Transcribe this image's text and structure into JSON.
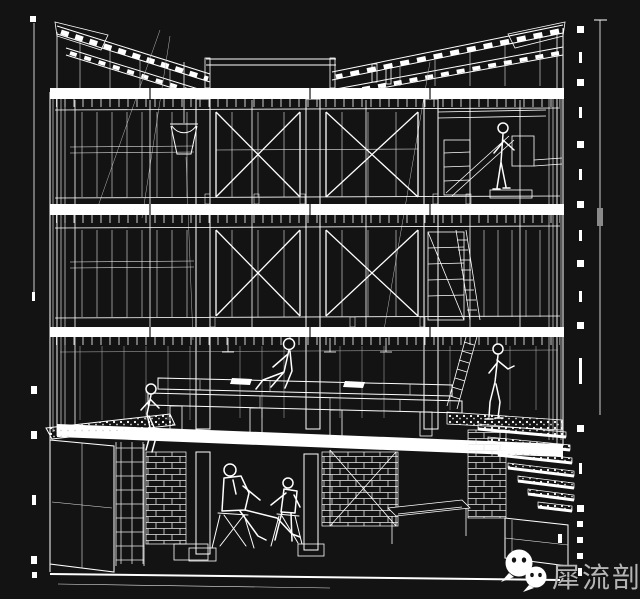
{
  "page": {
    "background_color": "#131313",
    "linework_color": "#ffffff",
    "description": "White wireframe sectional perspective drawing of a three-story timber/steel frame building with basement, on black background"
  },
  "drawing": {
    "elements": [
      "butterfly-roof-framing",
      "floor-slab-bands",
      "structural-columns",
      "window-mullion-grids",
      "x-cross-bracing",
      "hanging-bucket",
      "shelving-rack",
      "ladders",
      "stage-platform",
      "planter-counter",
      "basement-brick-walls",
      "terrace-stairs",
      "survey-tick-marks",
      "scale-ruler"
    ],
    "figures": [
      "person-standing-upper-right",
      "person-seated-on-platform-center",
      "woman-seated-on-counter-left",
      "man-in-suit-on-chair-basement",
      "person-on-chair-basement",
      "woman-standing-ground-right"
    ]
  },
  "watermark": {
    "icon": "wechat-chat-bubbles-icon",
    "icon_color": "#ffffff",
    "text": "犀流剖报",
    "text_color": "#b5b5b5"
  }
}
